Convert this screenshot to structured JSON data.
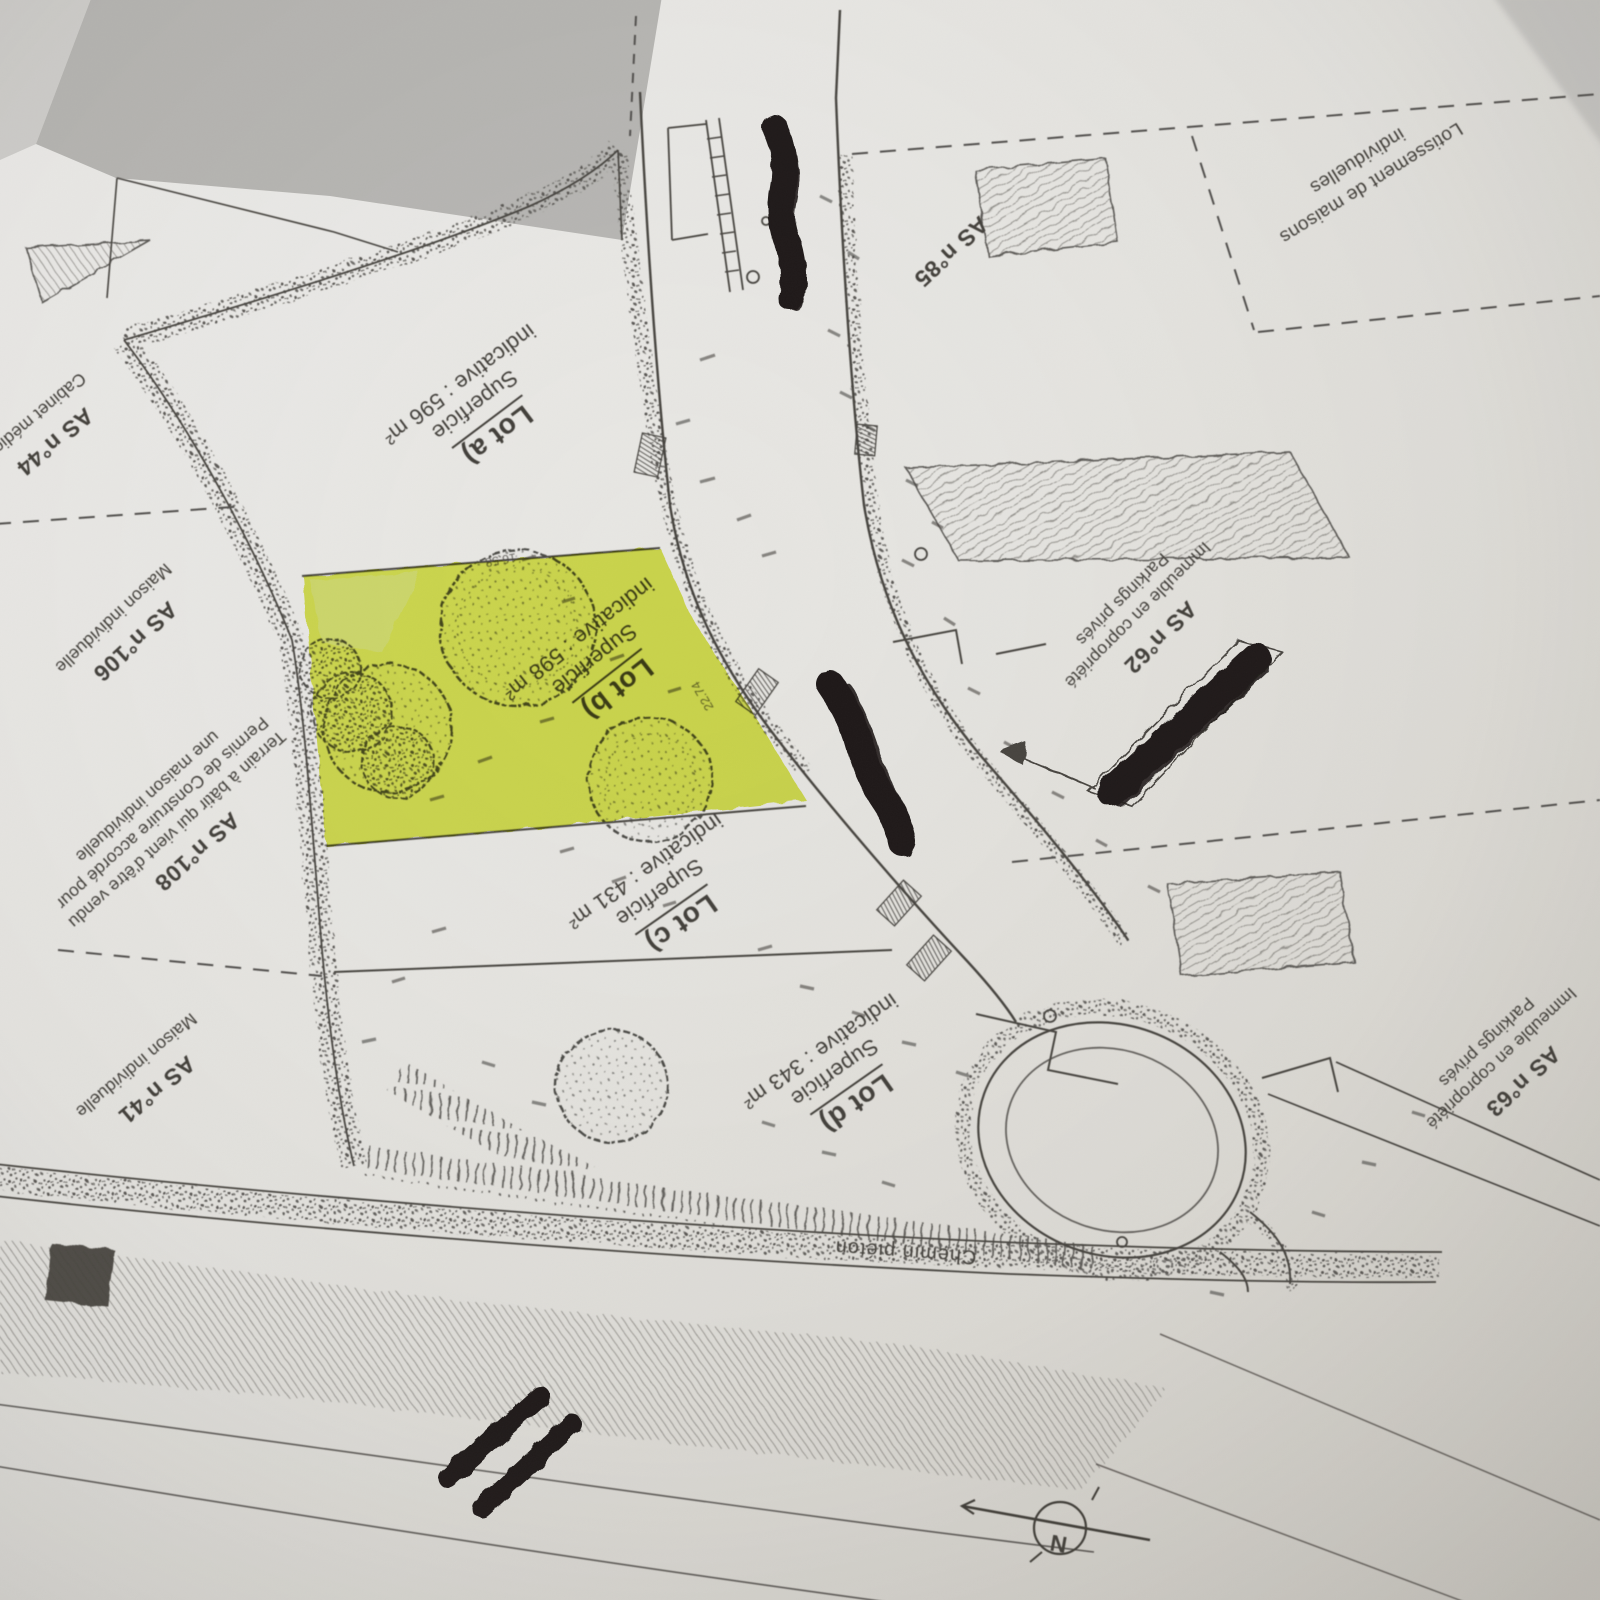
{
  "photo": {
    "paper_color": "#e9e8e5",
    "tone_color": "#b6b5b2",
    "ink_color": "#45423e",
    "highlight_color": "#d8e636",
    "marker_color": "#1c1916"
  },
  "plan": {
    "lots": [
      {
        "name": "Lot a)",
        "area_line_1": "Superficie",
        "area_line_2": "indicative : 596 m²",
        "highlighted": false
      },
      {
        "name": "Lot b)",
        "area_line_1": "Superficie",
        "area_line_2": "indicative : 598 m²",
        "highlighted": true
      },
      {
        "name": "Lot c)",
        "area_line_1": "Superficie",
        "area_line_2": "indicative : 431 m²",
        "highlighted": false
      },
      {
        "name": "Lot d)",
        "area_line_1": "Superficie",
        "area_line_2": "indicative : 343 m²",
        "highlighted": false
      }
    ],
    "parcels": [
      {
        "ref": "AS n°44",
        "notes": [
          "Cabinet médical"
        ]
      },
      {
        "ref": "AS n°106",
        "notes": [
          "Maison individuelle"
        ]
      },
      {
        "ref": "AS n°108",
        "notes": [
          "Terrain à bâtir qui vient d'être vendu",
          "Permis de Construire accordé pour",
          "une maison individuelle"
        ]
      },
      {
        "ref": "AS n°41",
        "notes": [
          "Maison individuelle"
        ]
      },
      {
        "ref": "AS n°85",
        "notes": []
      },
      {
        "ref": "AS n°62",
        "notes": [
          "Immeuble en copropriété",
          "Parkings privés"
        ]
      },
      {
        "ref": "AS n°63",
        "notes": [
          "Immeuble en copropriété",
          "Parkings privés"
        ]
      }
    ],
    "labels": {
      "zone_line_1": "Lotissement de maisons",
      "zone_line_2": "individuelles",
      "path": "Chemin piéton",
      "north": "N"
    },
    "dimensions": [
      "16.58",
      "22.74"
    ]
  }
}
